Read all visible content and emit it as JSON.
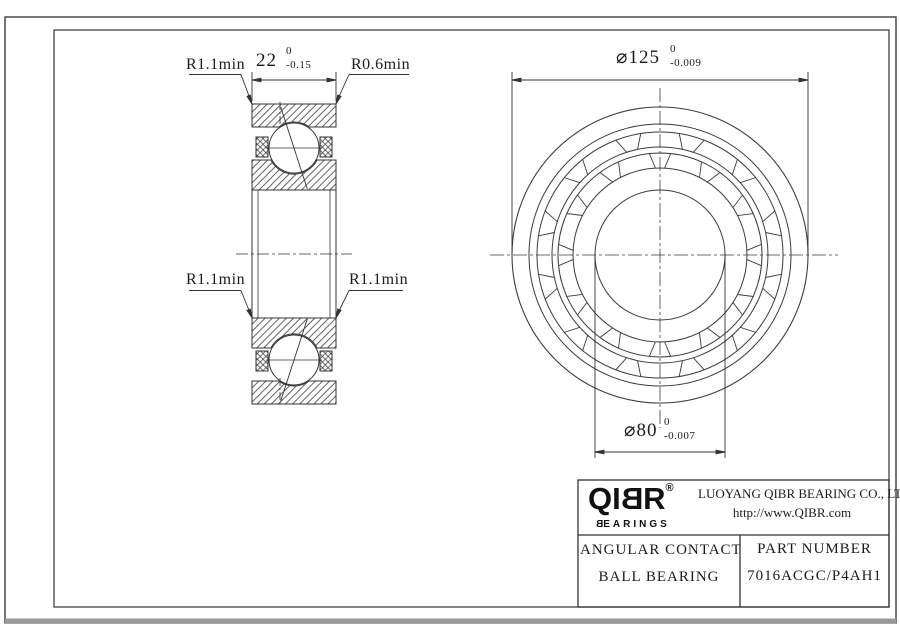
{
  "sheet": {
    "annotations": {
      "chamfer_top_left": "R1.1min",
      "chamfer_top_right": "R0.6min",
      "chamfer_mid_left": "R1.1min",
      "chamfer_mid_right": "R1.1min",
      "width_dim": {
        "value": "22",
        "upper": "0",
        "lower": "-0.15"
      },
      "outer_diameter_dim": {
        "value": "⌀125",
        "upper": "0",
        "lower": "-0.009"
      },
      "bore_diameter_dim": {
        "value": "⌀80",
        "upper": "0",
        "lower": "-0.007"
      }
    },
    "title_block": {
      "logo": {
        "part1": "QI",
        "part2_flipped": "B",
        "part3": "R",
        "registered": "®",
        "sub_first_flipped": "B",
        "sub_rest": "EARINGS"
      },
      "company_name": "LUOYANG QIBR BEARING CO., LTD",
      "website": "http://www.QIBR.com",
      "product_type_line1": "ANGULAR CONTACT",
      "product_type_line2": "BALL BEARING",
      "part_number_label": "PART NUMBER",
      "part_number_value": "7016ACGC/P4AH1"
    },
    "colors": {
      "line": "#333333",
      "text": "#1b1b1b",
      "frame_shadow": "#9a9a9a"
    }
  }
}
